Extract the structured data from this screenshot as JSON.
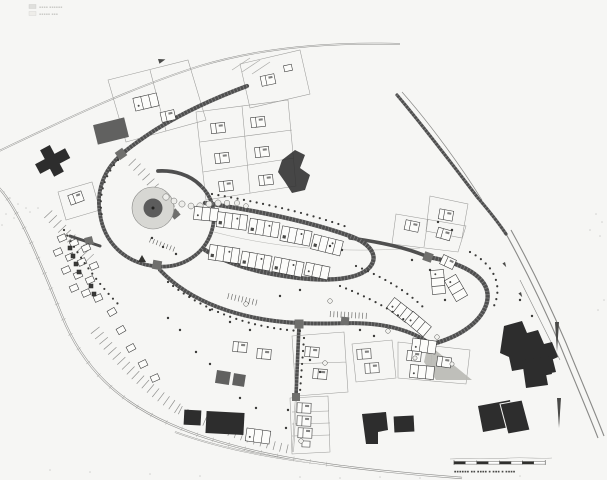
{
  "meta": {
    "artifact": "Scanned black-and-white architectural site plan of a hillside housing estate",
    "drawing_style": "hand-drawn ink plan, no legible text"
  },
  "palette": {
    "paper": "#f6f6f4",
    "ink": "#2f2f2f",
    "road_dark": "#4f4f4f",
    "road_light": "#8a8a88",
    "building_solid": "#2d2d2d",
    "building_gray": "#616160",
    "plaza_ring": "#d7d7d3",
    "pond": "#5c5c5c",
    "paving": "#b9b9b4",
    "tree": "#3a3a38"
  },
  "legend": {
    "position": "top-left",
    "illegible": true,
    "rows": [
      "▪▪▪▪ ▪▪▪▪▪▪",
      "▪▪▪▪▪ ▪▪▪"
    ]
  },
  "scale_bar": {
    "position": "bottom-right",
    "segments": 8,
    "caption_illegible": true,
    "caption": "▪▪▪▪▪▪ ▪▪ ▪▪▪▪ ▪ ▪▪▪ ▪ ▪▪▪▪"
  },
  "features": [
    {
      "id": "circular-plaza",
      "label": "circular plaza with central pond"
    },
    {
      "id": "main-street-loop",
      "label": "curved main street with terraced row housing"
    },
    {
      "id": "north-access-road",
      "label": "north-east access road"
    },
    {
      "id": "perimeter-road",
      "label": "perimeter road around the estate"
    },
    {
      "id": "east-housing-loop",
      "label": "eastern loop with row houses"
    },
    {
      "id": "detached-house-plots",
      "label": "detached house plots with gardens"
    },
    {
      "id": "existing-buildings",
      "label": "existing buildings drawn solid dark"
    },
    {
      "id": "tree-rows",
      "label": "tree rows and single trees"
    },
    {
      "id": "scale-bar",
      "label": "graphic scale bar"
    },
    {
      "id": "legend",
      "label": "small legend box (illegible)"
    }
  ]
}
